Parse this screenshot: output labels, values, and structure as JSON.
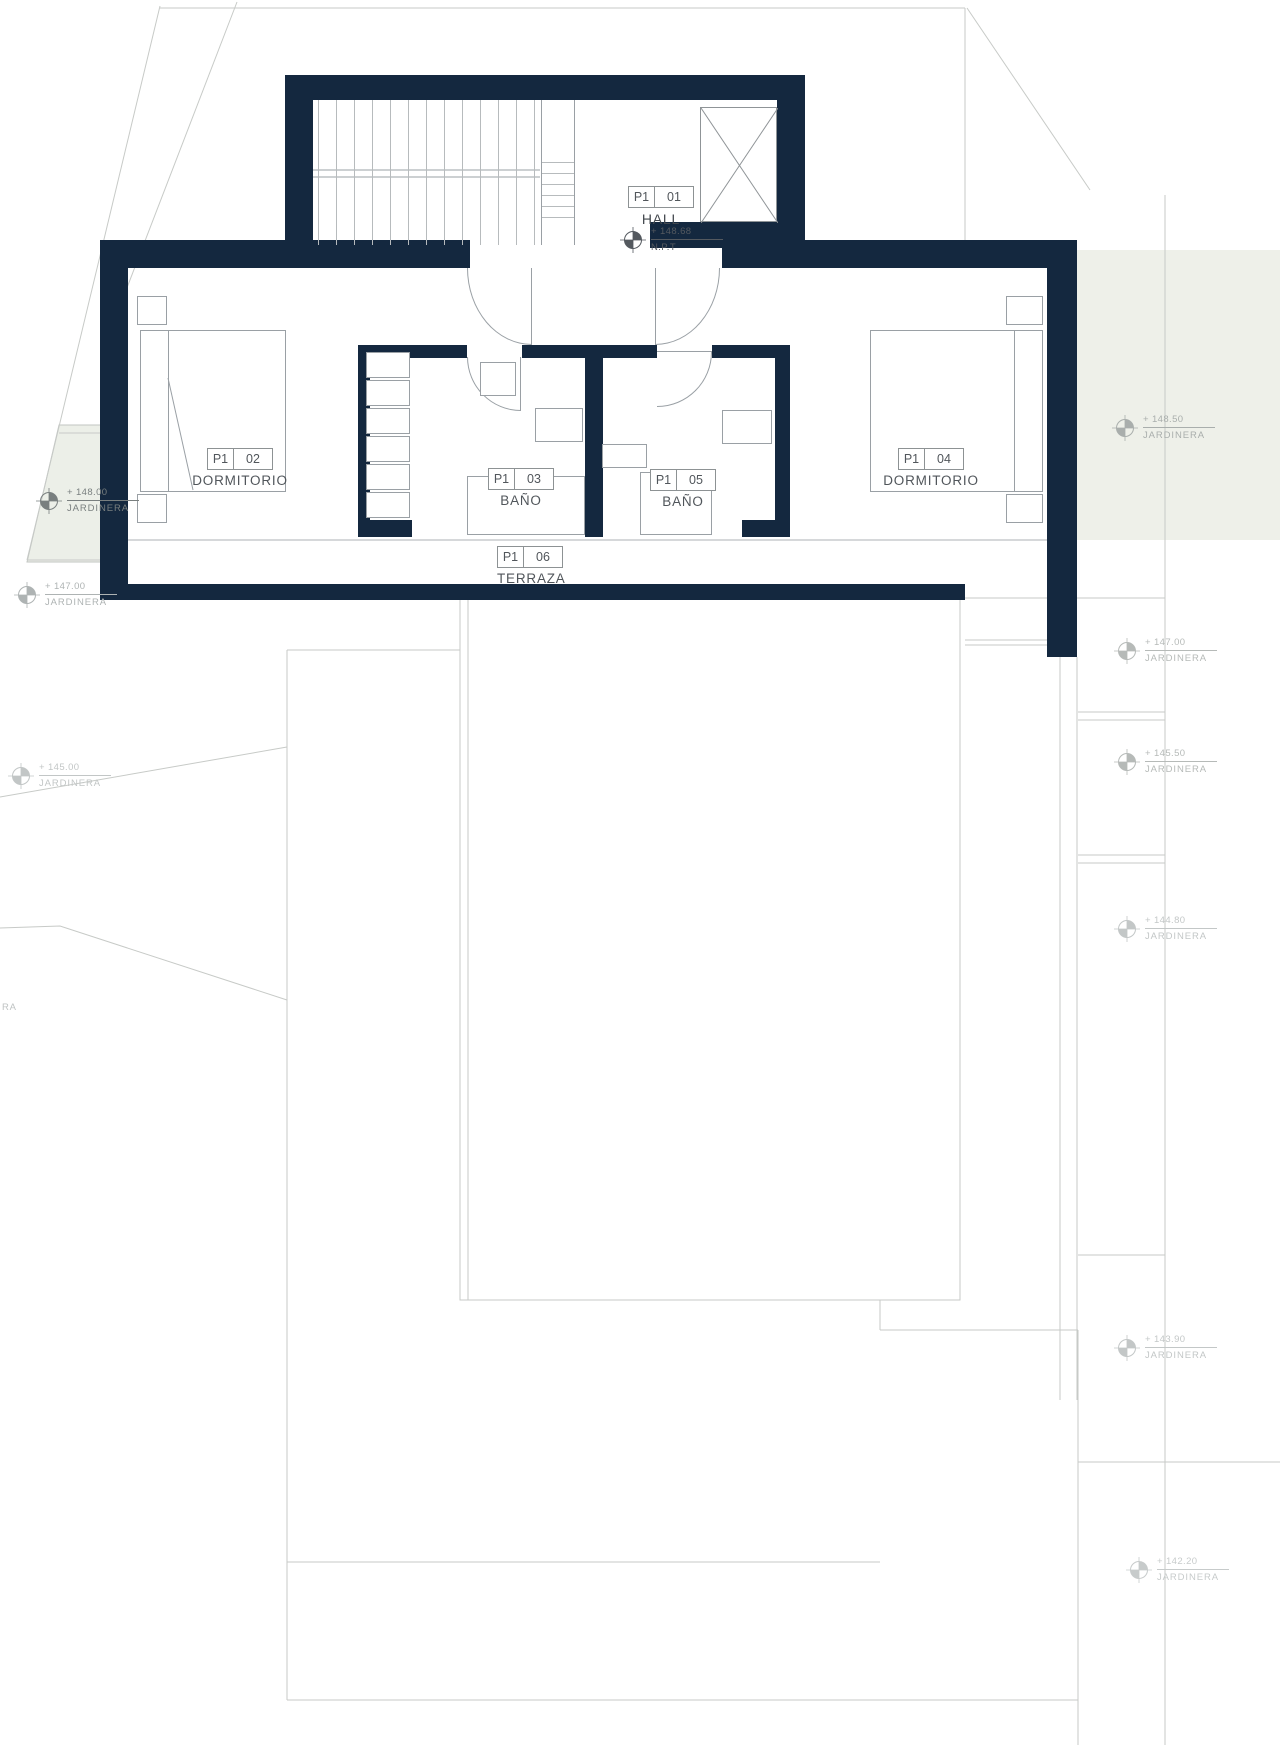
{
  "drawing": {
    "rooms": [
      {
        "tag_prefix": "P1",
        "tag_number": "01",
        "name": "HALL"
      },
      {
        "tag_prefix": "P1",
        "tag_number": "02",
        "name": "DORMITORIO"
      },
      {
        "tag_prefix": "P1",
        "tag_number": "03",
        "name": "BAÑO"
      },
      {
        "tag_prefix": "P1",
        "tag_number": "05",
        "name": "BAÑO"
      },
      {
        "tag_prefix": "P1",
        "tag_number": "04",
        "name": "DORMITORIO"
      },
      {
        "tag_prefix": "P1",
        "tag_number": "06",
        "name": "TERRAZA"
      }
    ],
    "hall_level": {
      "elevation": "+ 148.68",
      "datum": "N.P.T"
    },
    "planter_markers": [
      {
        "elevation": "+ 148.00",
        "label": "JARDINERA"
      },
      {
        "elevation": "+ 147.00",
        "label": "JARDINERA"
      },
      {
        "elevation": "+ 145.00",
        "label": "JARDINERA"
      },
      {
        "elevation": "+ 148.50",
        "label": "JARDINERA"
      },
      {
        "elevation": "+ 147.00",
        "label": "JARDINERA"
      },
      {
        "elevation": "+ 145.50",
        "label": "JARDINERA"
      },
      {
        "elevation": "+ 144.80",
        "label": "JARDINERA"
      },
      {
        "elevation": "+ 143.90",
        "label": "JARDINERA"
      },
      {
        "elevation": "+ 142.20",
        "label": "JARDINERA"
      }
    ],
    "edge_label": "RA",
    "colors": {
      "wall": "#14283f",
      "planter_fill": "#edf0e9"
    }
  }
}
